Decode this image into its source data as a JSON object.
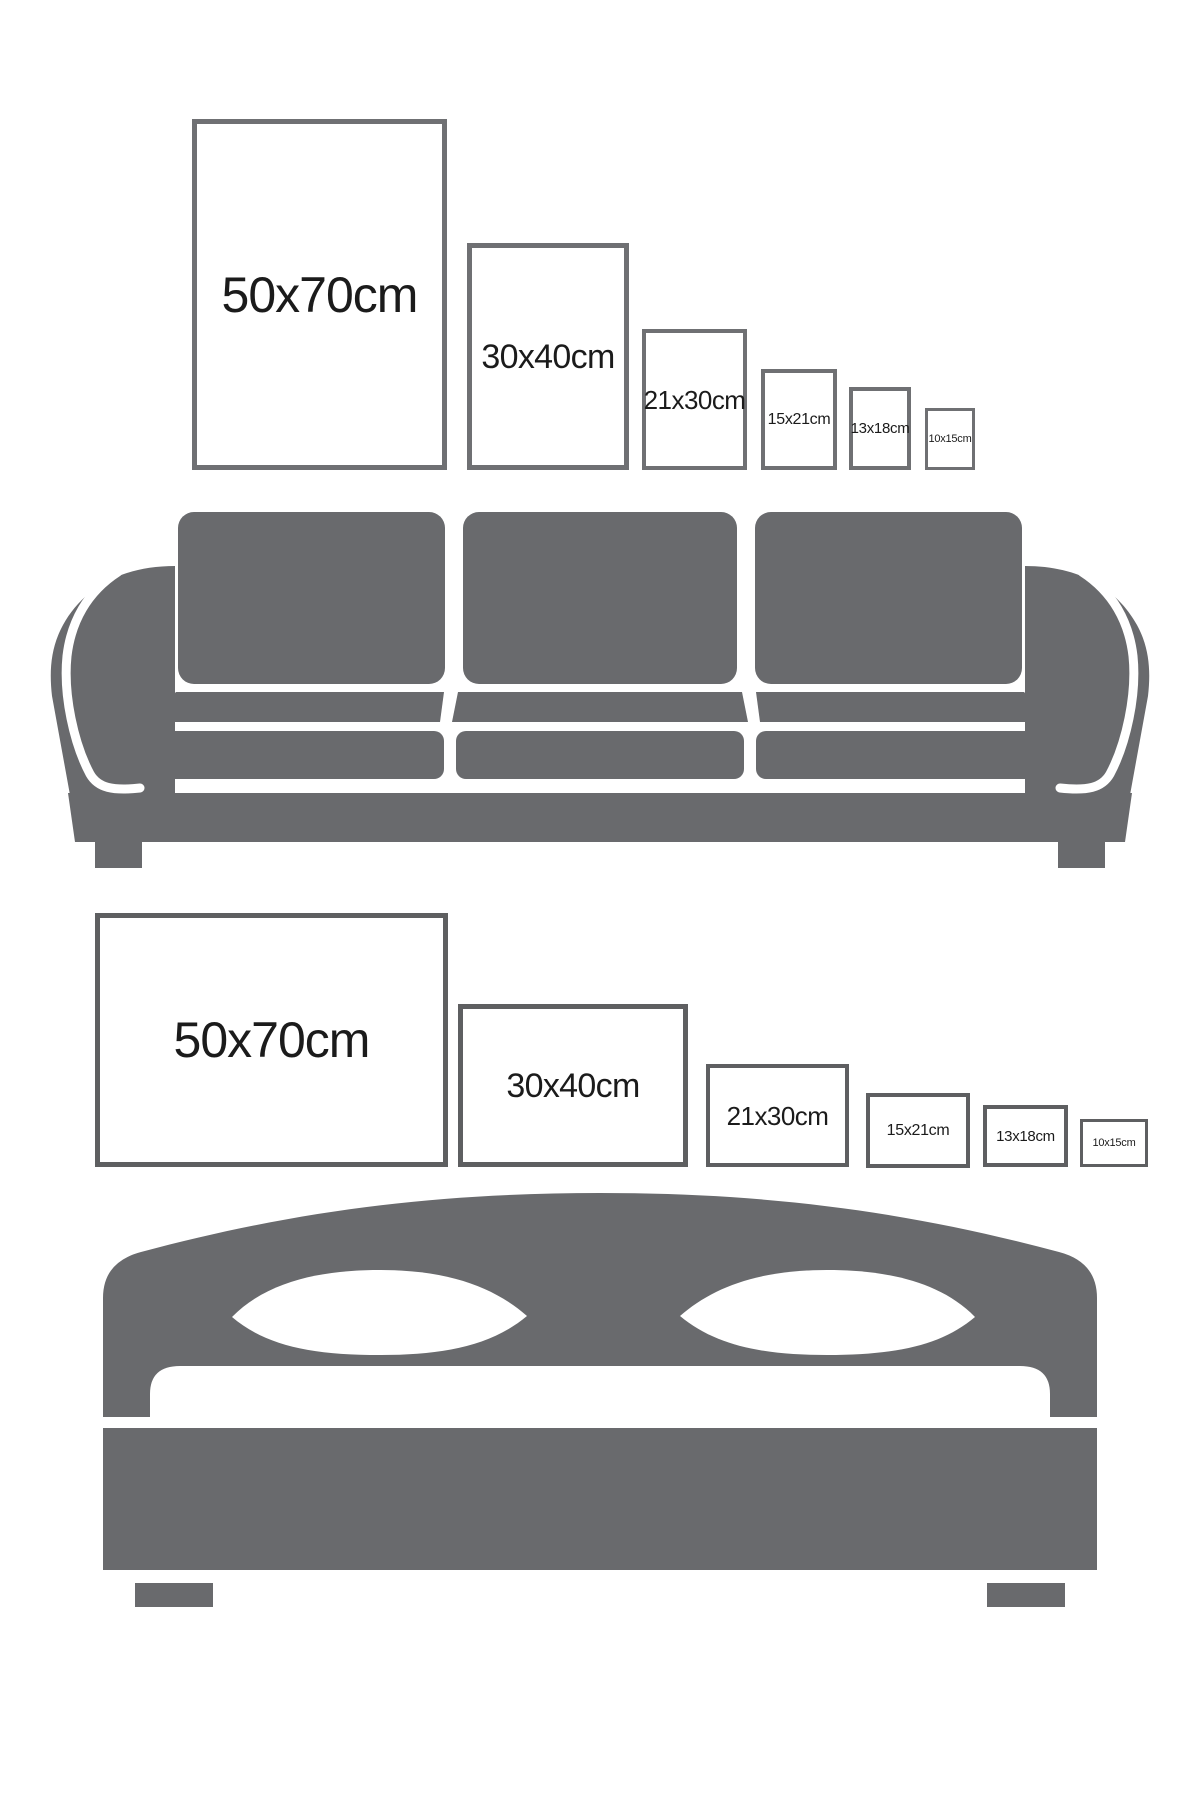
{
  "infographic": {
    "title_hint": "poster size comparison guide",
    "colors": {
      "background": "#ffffff",
      "furniture_gray": "#696a6d",
      "frame_border_top_row": "#6f7073",
      "frame_border_bottom_row": "#5e5f61",
      "label_text": "#1b1b1b"
    },
    "top_row": {
      "orientation": "portrait",
      "furniture_below": "sofa",
      "frames": [
        {
          "label": "50x70cm"
        },
        {
          "label": "30x40cm"
        },
        {
          "label": "21x30cm"
        },
        {
          "label": "15x21cm"
        },
        {
          "label": "13x18cm"
        },
        {
          "label": "10x15cm"
        }
      ]
    },
    "bottom_row": {
      "orientation": "landscape",
      "furniture_below": "bed",
      "frames": [
        {
          "label": "50x70cm"
        },
        {
          "label": "30x40cm"
        },
        {
          "label": "21x30cm"
        },
        {
          "label": "15x21cm"
        },
        {
          "label": "13x18cm"
        },
        {
          "label": "10x15cm"
        }
      ]
    },
    "sofa": {
      "description": "three-seat sofa silhouette"
    },
    "bed": {
      "description": "double bed with two pillows silhouette"
    }
  }
}
